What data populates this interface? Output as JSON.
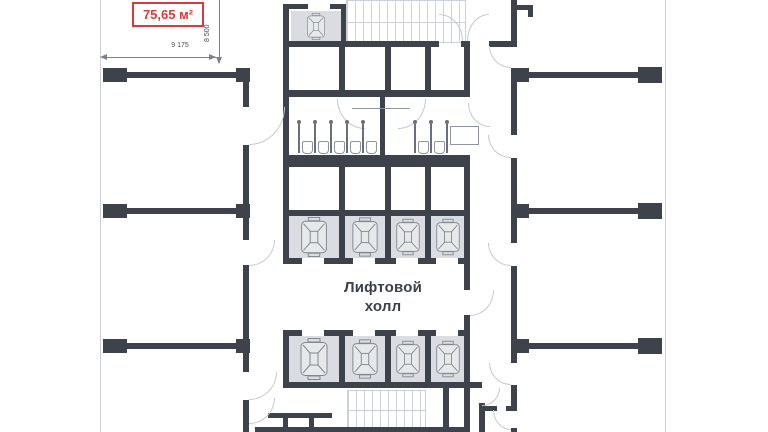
{
  "plan": {
    "area_label": "75,65 м²",
    "dim_width_label": "9 175",
    "dim_height_label": "8 500",
    "elevator_hall_line1": "Лифтовой",
    "elevator_hall_line2": "холл"
  },
  "colors": {
    "wall": "#3e434b",
    "accent_red": "#d93a3a",
    "elevator_cell": "#dadce1",
    "line_light": "#ccd0d7"
  },
  "icons": [
    {
      "name": "elevator-car-icon",
      "meaning": "elevator car symbol in shaft"
    },
    {
      "name": "staircase",
      "meaning": "stair flight with treads"
    },
    {
      "name": "door-arc",
      "meaning": "door swing arc"
    },
    {
      "name": "toilet-icon",
      "meaning": "toilet fixture in WC stall"
    }
  ]
}
